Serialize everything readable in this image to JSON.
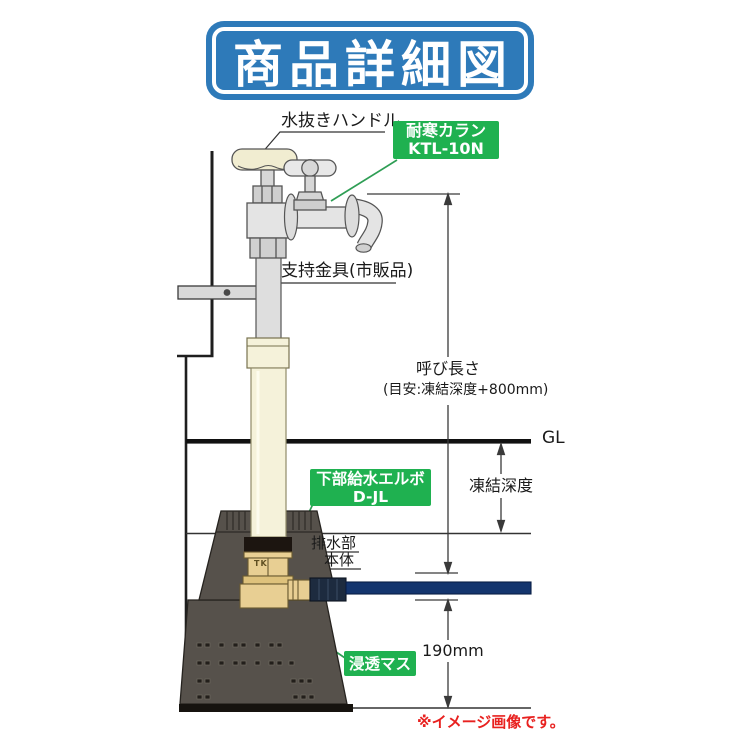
{
  "title": "商品詳細図",
  "note": "※イメージ画像です。",
  "labels": {
    "drain_handle": "水抜きハンドル",
    "support_bracket": "支持金具(市販品)",
    "nominal_length": "呼び長さ",
    "nominal_length_hint": "(目安:凍結深度+800mm)",
    "ground_level": "GL",
    "frost_depth": "凍結深度",
    "drain_part": "排水部",
    "main_body": "本体",
    "basin_height": "190mm",
    "tk_mark": "TK"
  },
  "callouts": {
    "faucet_model": {
      "line1": "耐寒カラン",
      "line2": "KTL-10N"
    },
    "elbow_model": {
      "line1": "下部給水エルボ",
      "line2": "D-JL"
    },
    "basin": "浸透マス"
  },
  "colors": {
    "title_blue": "#2e7ab9",
    "callout_green": "#1fb150",
    "leader_green": "#2f9e55",
    "note_red": "#e8211f",
    "pipe_navy": "#14356e",
    "brass": "#e8cf93",
    "basin_gray": "#56514b",
    "pipe_cream": "#f5f2da"
  }
}
